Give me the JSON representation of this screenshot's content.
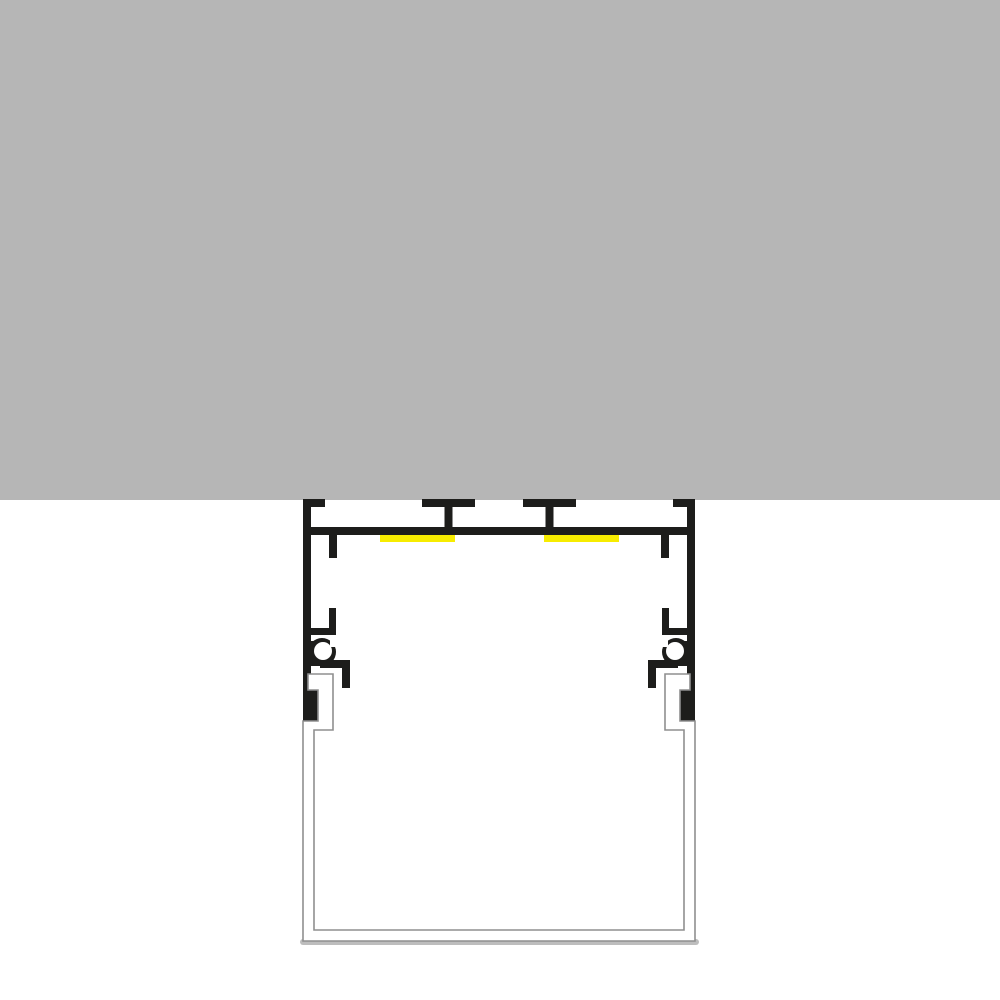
{
  "drawing": {
    "kind": "technical-cross-section",
    "subject": "ceiling-mounted-led-aluminium-profile-with-diffuser"
  },
  "colors": {
    "background": "#ffffff",
    "ceiling": "#b6b6b6",
    "profile": "#1d1d1b",
    "led_strip": "#f7ec00",
    "diffuser_fill": "#ffffff",
    "diffuser_outline": "#8f8f8f",
    "diffuser_shadow": "#bdbdbd"
  }
}
